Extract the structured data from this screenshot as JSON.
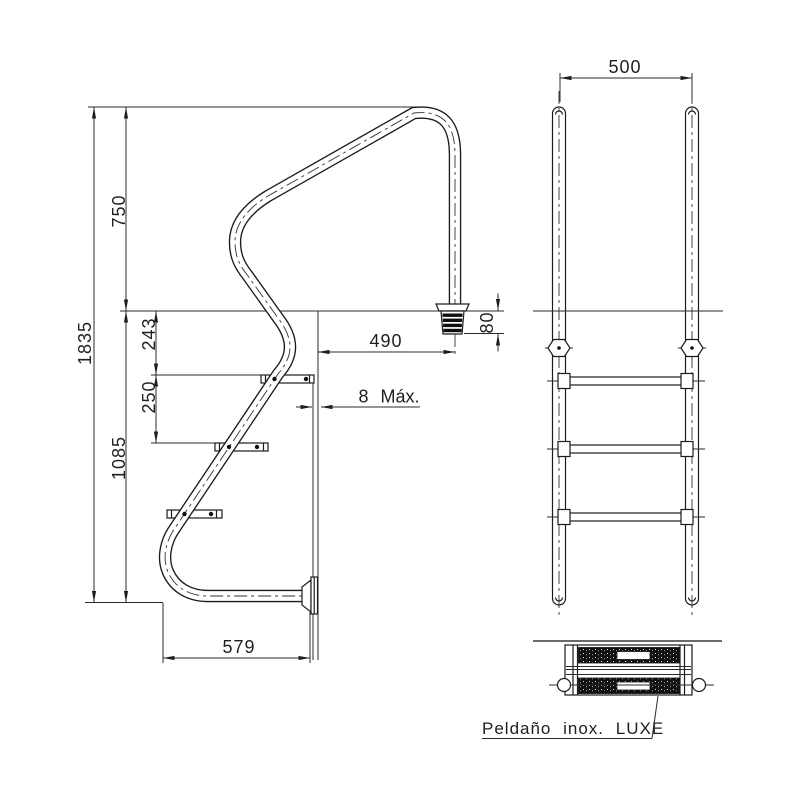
{
  "side_view": {
    "overall_height": "1835",
    "height_above_water": "750",
    "water_to_first_step": "243",
    "step_spacing": "250",
    "height_below_water": "1085",
    "horizontal_reach": "490",
    "anchor_embed_depth": "80",
    "wall_clearance": "8 Máx.",
    "base_depth": "579"
  },
  "front_view": {
    "rail_spacing": "500"
  },
  "detail": {
    "step_label": "Peldaño inox. LUXE"
  }
}
